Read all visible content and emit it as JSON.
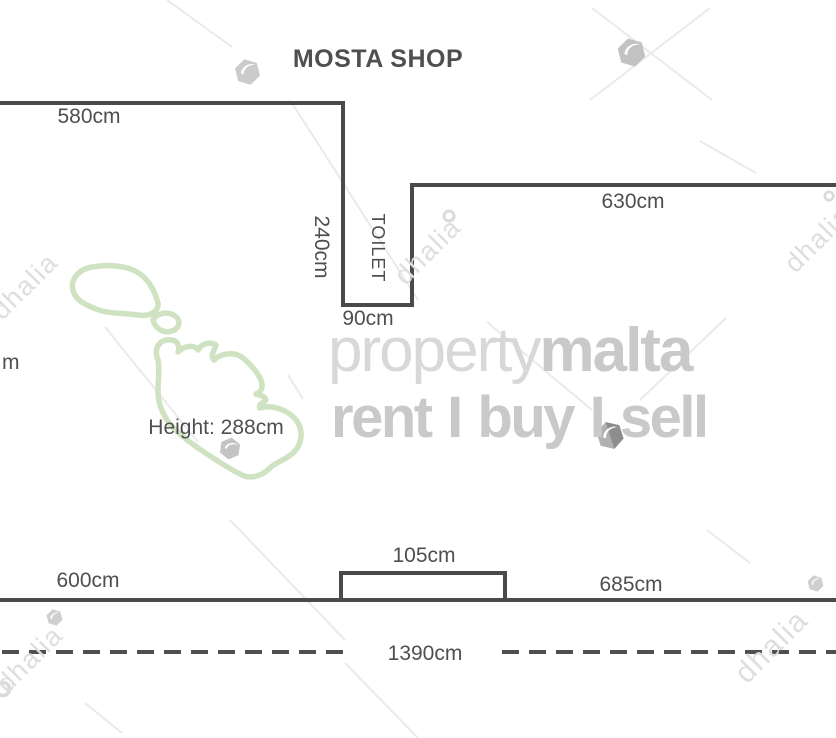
{
  "plan": {
    "title": "MOSTA SHOP",
    "room_label": "TOILET",
    "height_note": "Height: 288cm",
    "dimensions": {
      "top_left_wall": "580cm",
      "toilet_depth": "240cm",
      "toilet_width": "90cm",
      "top_right_wall": "630cm",
      "left_edge_partial": "m",
      "bottom_left_wall": "600cm",
      "recess_width": "105cm",
      "bottom_right_wall": "685cm",
      "total_frontage": "1390cm"
    }
  },
  "watermark": {
    "agency": "dhalia",
    "brand_regular": "property",
    "brand_bold": "malta",
    "tagline": "rent I buy I sell"
  },
  "colors": {
    "wall": "#4a4a4a",
    "ink": "#4f4f4f",
    "wm_light": "#d8d8d8",
    "wm_mid": "#c9c9c9",
    "wm_faint": "#dedede",
    "malta_green": "#cfe3c3",
    "crease": "#eaeaea",
    "logo_gray": "#c9c9c9",
    "logo_dark": "#8d8d8d"
  }
}
